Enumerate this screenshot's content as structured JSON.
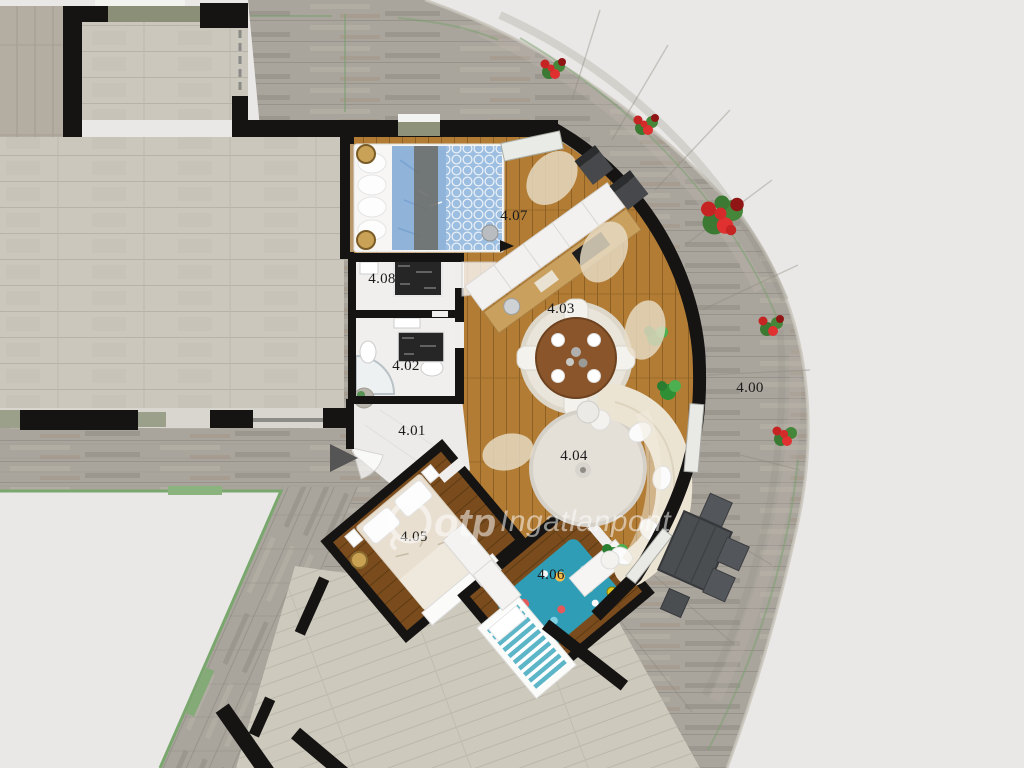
{
  "watermark": {
    "brand": "otp",
    "name": "Ingatlanpont"
  },
  "labels": [
    {
      "text": "4.00"
    },
    {
      "text": "4.01"
    },
    {
      "text": "4.02"
    },
    {
      "text": "4.03"
    },
    {
      "text": "4.04"
    },
    {
      "text": "4.05"
    },
    {
      "text": "4.06"
    },
    {
      "text": "4.07"
    },
    {
      "text": "4.08"
    }
  ],
  "colors": {
    "background": "#e9e8e6",
    "wall": "#151413",
    "tile_floor": "#cbc7bd",
    "stone_terrace": "#a9a49c",
    "wood_floor": "#b27c35",
    "wood_floor_dark": "#7a4c1d",
    "white_room": "#f0efed",
    "bed_blue": "#8fb3d9",
    "kids_rug_teal": "#2f9db6",
    "flower_red": "#c62323",
    "plant_green": "#3a9440",
    "rail_green": "#79a76d",
    "watermark_white": "#ffffff"
  }
}
